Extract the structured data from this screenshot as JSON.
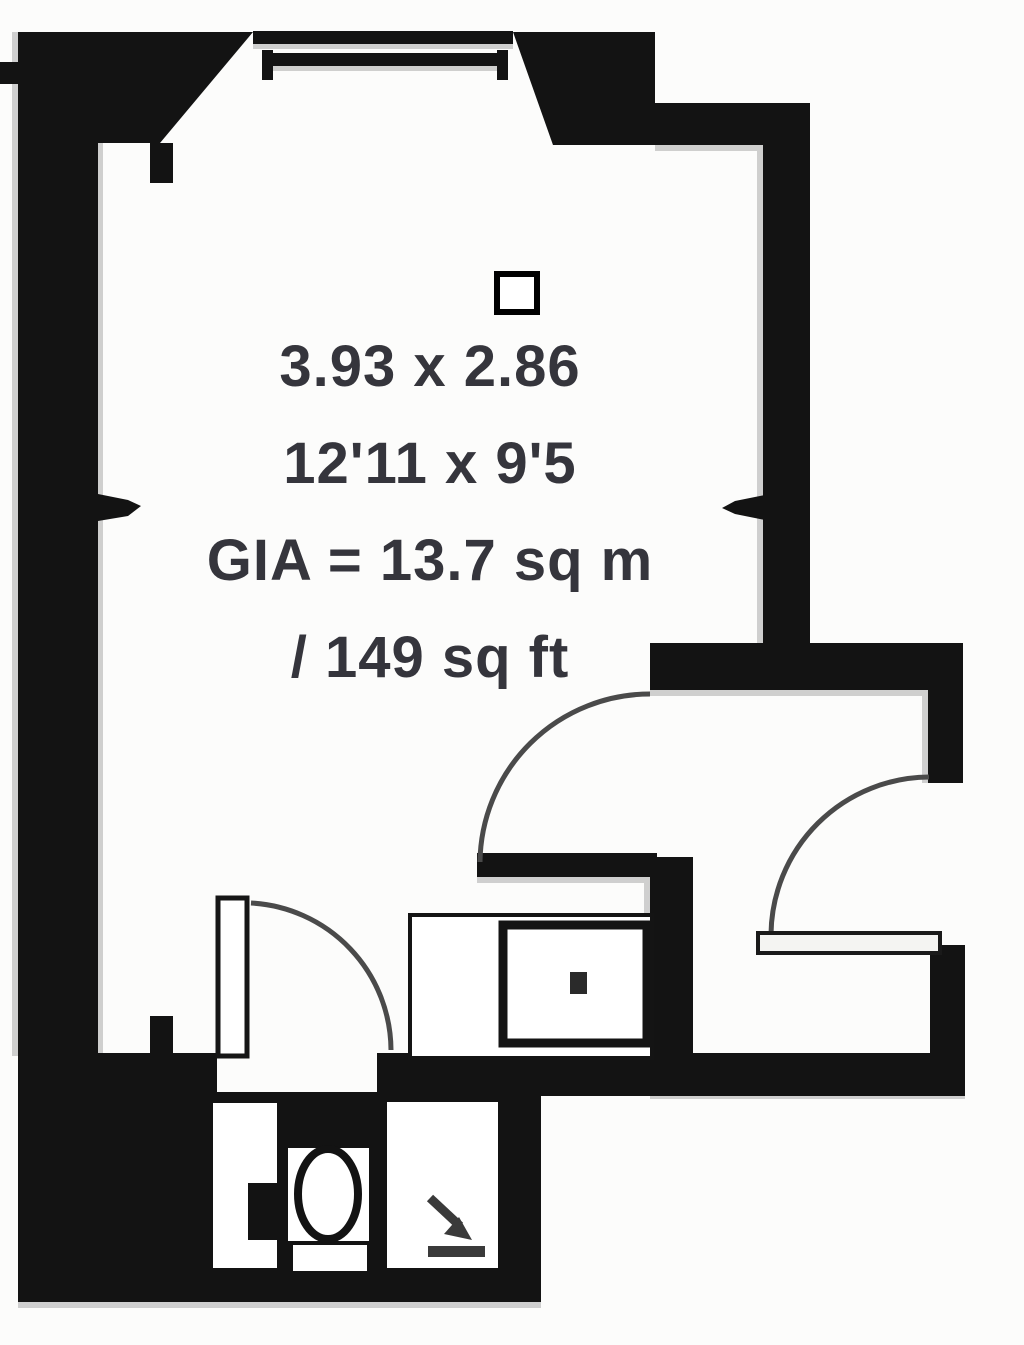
{
  "plan": {
    "title": "Studio flat floor plan",
    "room_label": {
      "dimensions_metric": "3.93 x 2.86",
      "dimensions_imperial": "12'11 x 9'5",
      "area_metric": "GIA = 13.7 sq m",
      "area_imperial": "/ 149 sq ft"
    },
    "colors": {
      "wall": "#131313",
      "text": "#35353c",
      "background": "#fcfcfb",
      "door_arc": "#4a4a4a",
      "shadow": "#999999"
    },
    "fixtures": [
      "window",
      "studio-entry-door",
      "hall-door",
      "bathroom-door",
      "vanity-unit",
      "toilet",
      "shower",
      "wall-measurement-ticks",
      "column-symbol"
    ]
  }
}
